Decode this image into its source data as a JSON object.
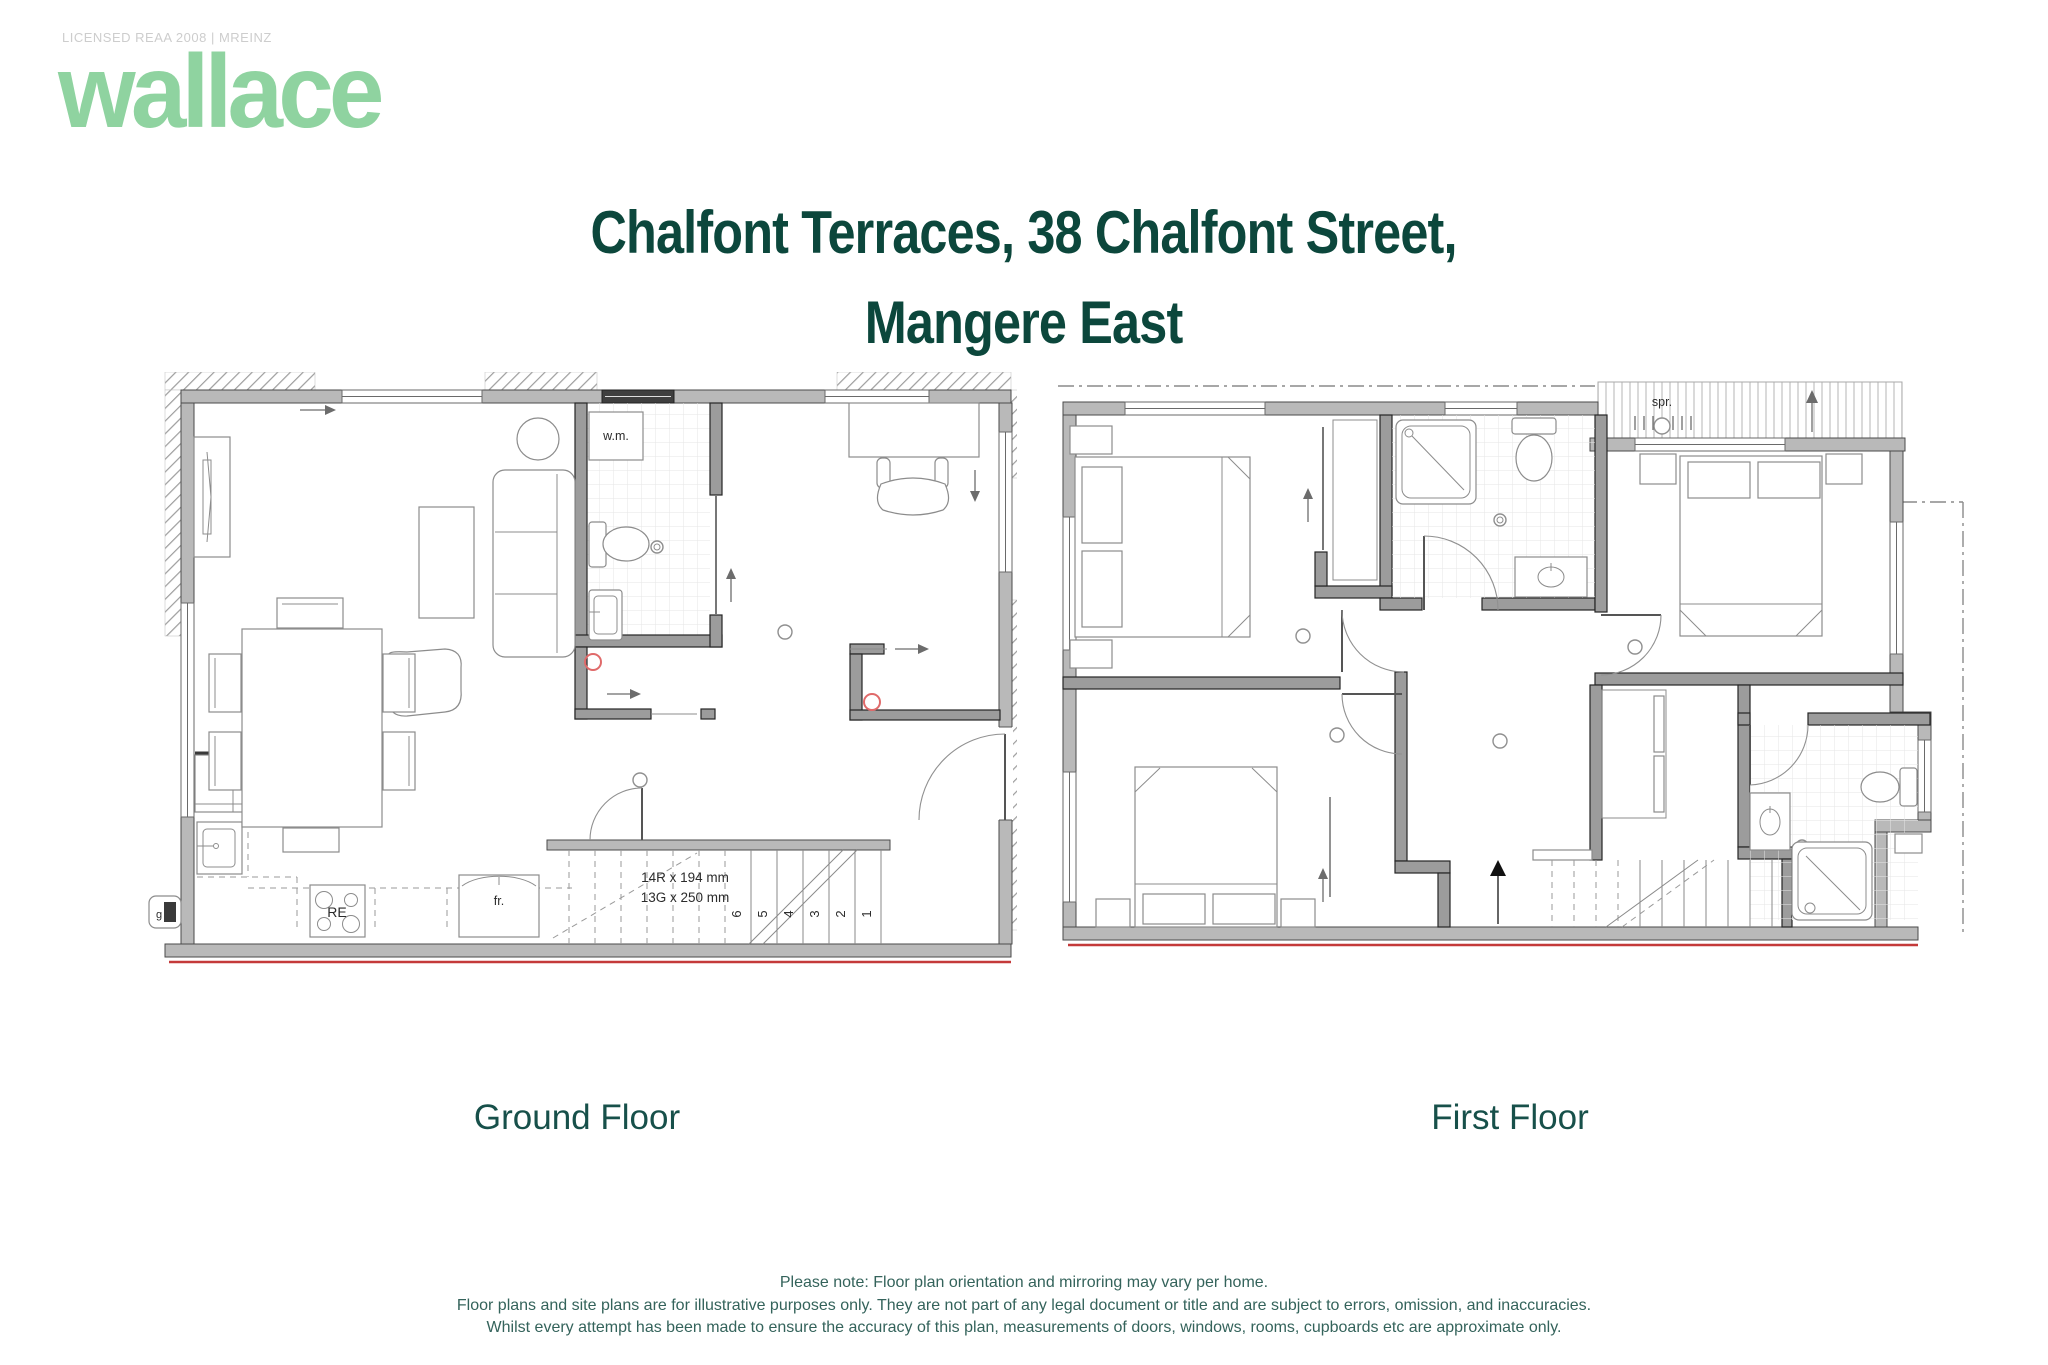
{
  "brand": {
    "license_text": "LICENSED REAA 2008 | MREINZ",
    "logo_text": "wallace",
    "logo_color": "#8fd3a0"
  },
  "title": {
    "line1": "Chalfont Terraces, 38 Chalfont Street,",
    "line2": "Mangere East",
    "color": "#0c473c"
  },
  "plans": {
    "ground": {
      "label": "Ground Floor",
      "stair_note_line1": "14R x 194 mm",
      "stair_note_line2": "13G x 250 mm",
      "stair_numbers": [
        "1",
        "2",
        "3",
        "4",
        "5",
        "6"
      ],
      "labels": {
        "wm": "w.m.",
        "dw": "d.w.",
        "fr": "fr.",
        "re": "RE",
        "g": "g"
      }
    },
    "first": {
      "label": "First Floor",
      "labels": {
        "spr": "spr."
      }
    }
  },
  "footer": {
    "line1": "Please note: Floor plan orientation and mirroring may vary per home.",
    "line2": "Floor plans and site plans are for illustrative purposes only. They are not part of any legal document or title and are subject to errors, omission, and inaccuracies.",
    "line3": "Whilst every attempt has been made to ensure the accuracy of this plan, measurements of doors, windows, rooms, cupboards etc are approximate only."
  }
}
